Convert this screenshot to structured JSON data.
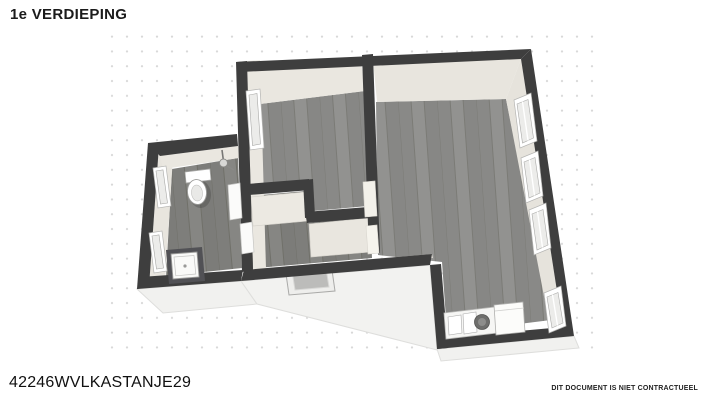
{
  "page": {
    "title": "1e VERDIEPING",
    "reference": "42246WVLKASTANJE29",
    "disclaimer": "DIT DOCUMENT IS NIET CONTRACTUEEL"
  },
  "colors": {
    "background": "#ffffff",
    "wall": "#3e3e3e",
    "wall_inner_face": "#eae7e0",
    "floor_wood": "#8d8d8b",
    "floor_wood_dark": "#80807e",
    "ground_slab": "#f1f1ef",
    "grid_dot": "#d8d8d8",
    "window_frame": "#ffffff",
    "window_glass": "#ececea",
    "shower_base": "#515155",
    "text": "#1a1a1a"
  },
  "floorplan": {
    "view": "3d-top-down-render",
    "rooms": [
      "bathroom",
      "room-middle",
      "hall-stairwell",
      "living-room-kitchen"
    ],
    "fixtures": [
      "toilet",
      "shower-tray",
      "wall-faucet",
      "kitchenette",
      "refrigerator",
      "skylight",
      "staircase"
    ],
    "window_count": 7,
    "door_count": 4
  }
}
